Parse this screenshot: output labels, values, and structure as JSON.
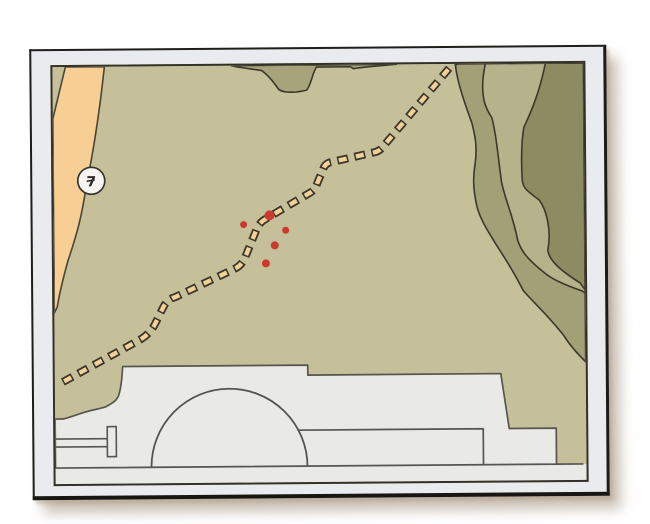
{
  "page": {
    "background": "#ffffff"
  },
  "frame": {
    "mat_color": "#e9ebee",
    "border_color": "#1f1e1a"
  },
  "map": {
    "base_color": "#c5c09a",
    "outline_color": "#3c382b",
    "road": {
      "fill": "#f7cf94",
      "shield_label": "7",
      "shield_fill": "#f6f5f1",
      "shield_outline": "#35332e"
    },
    "trail": {
      "dash_fill": "#f2d09a",
      "dash_outline": "#3b352a"
    },
    "terrain": {
      "top_band": "#a7a47b",
      "band_medium": "#a3a077",
      "band_light": "#b6b28b",
      "band_dark": "#8d8b62"
    },
    "building": {
      "fill": "#e9e9e6",
      "outline": "#57554e"
    },
    "markers": {
      "color": "#cc392e",
      "count": 5,
      "points": [
        {
          "x": 216,
          "y": 150,
          "r": 5
        },
        {
          "x": 190,
          "y": 159,
          "r": 3.5
        },
        {
          "x": 232,
          "y": 165,
          "r": 3.5
        },
        {
          "x": 221,
          "y": 180,
          "r": 4
        },
        {
          "x": 212,
          "y": 198,
          "r": 4
        }
      ]
    }
  }
}
